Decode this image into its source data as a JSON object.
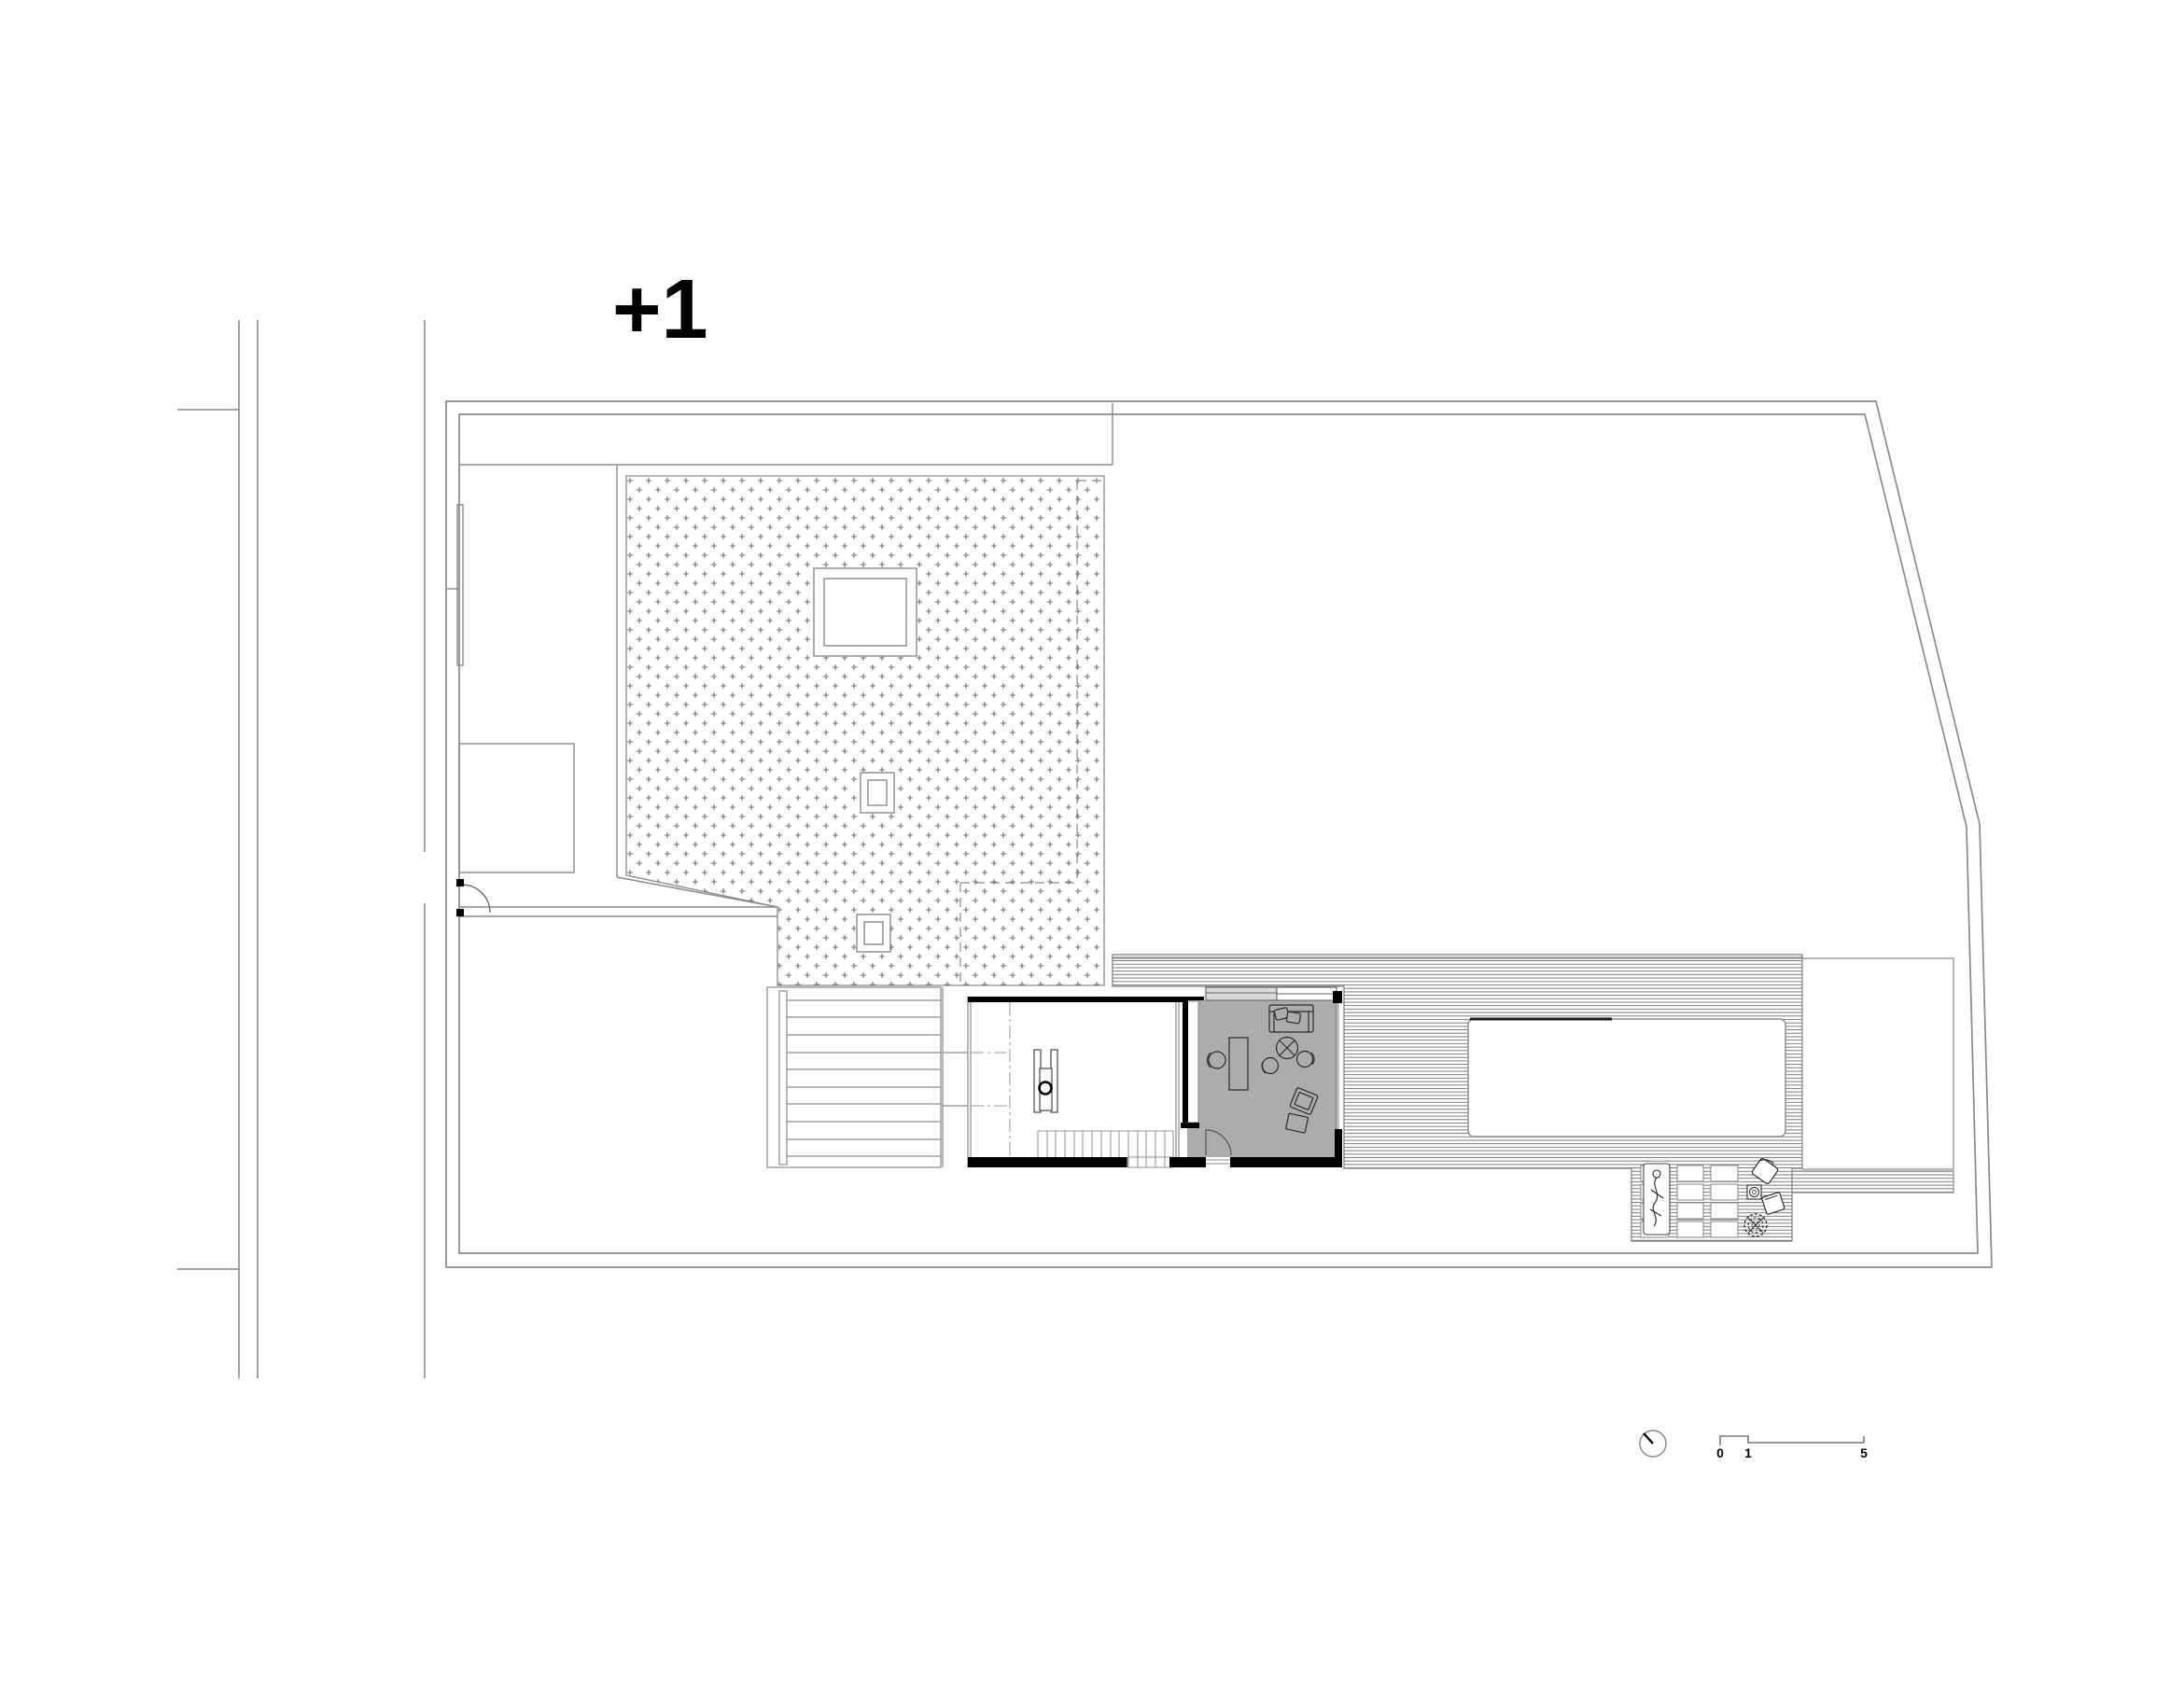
{
  "drawing": {
    "type": "architectural-floor-plan",
    "floor_label": "+1",
    "scale_bar": {
      "zero": "0",
      "one": "1",
      "five": "5"
    },
    "symbols": [
      "north-indicator-icon",
      "scale-bar",
      "plot-boundary",
      "road-edge",
      "gravel-roof-terrace",
      "skylight",
      "lower-floor-dashed-outline",
      "wide-garden-steps",
      "studio-room",
      "living-room",
      "wood-stove",
      "staircase",
      "swimming-pool",
      "timber-deck",
      "spa-duckboard-grid",
      "sun-lounger",
      "outdoor-chair",
      "outdoor-table",
      "plant",
      "lawn-panel",
      "garden-path",
      "garage-court",
      "gate-door-swing"
    ],
    "colors": {
      "background": "#ffffff",
      "wall": "#000000",
      "line": "#8a8a8a",
      "line_dark": "#2b2b2b",
      "hatch": "#6f6f6f",
      "stipple": "#707070",
      "room_fill": "#acacac",
      "window_fill": "#d9d9d9",
      "white": "#ffffff"
    }
  }
}
